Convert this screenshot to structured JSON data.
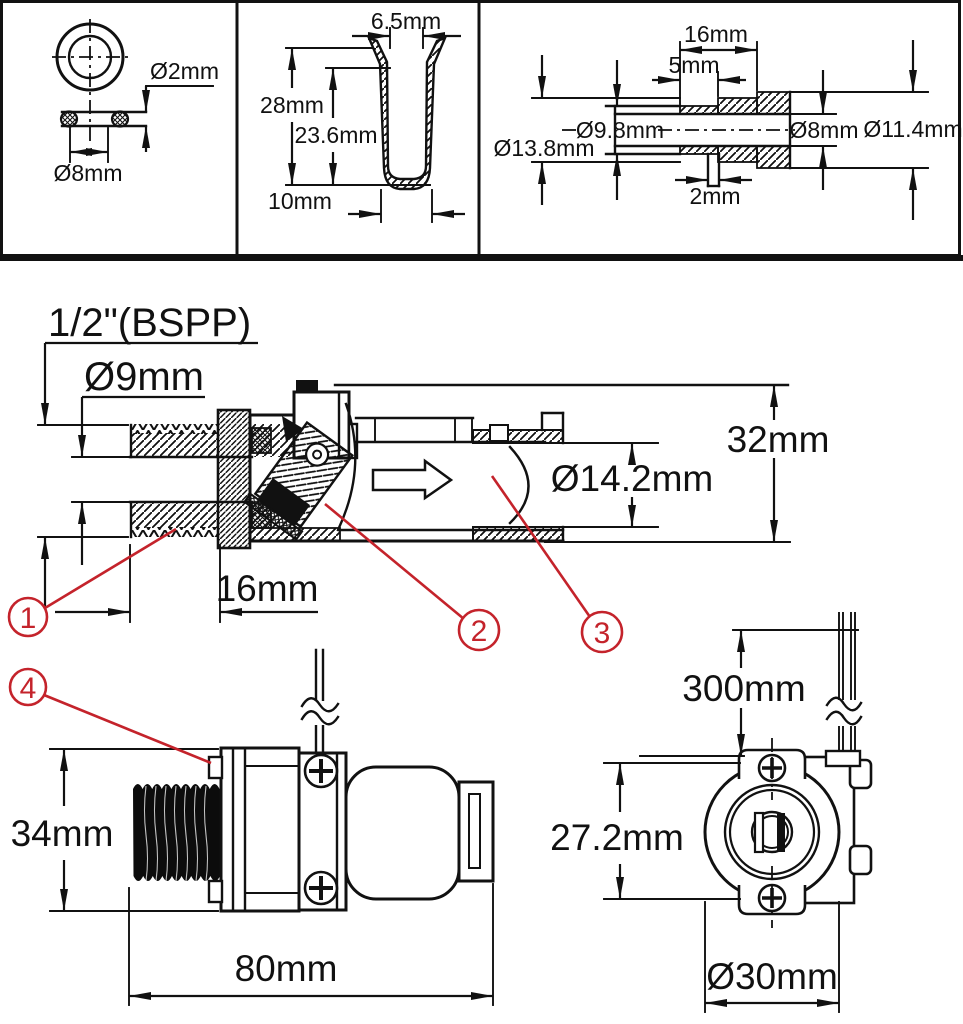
{
  "title": "Solenoid valve dimensional drawing",
  "colors": {
    "line": "#111111",
    "callout": "#c4232b",
    "background": "#ffffff"
  },
  "panels": {
    "oring": {
      "cross_section": "Ø2mm",
      "inner_diameter": "Ø8mm"
    },
    "filter": {
      "opening": "6.5mm",
      "height": "28mm",
      "inner_height": "23.6mm",
      "base": "10mm"
    },
    "fitting": {
      "length": "16mm",
      "step": "5mm",
      "tube_od": "Ø9.8mm",
      "flange_od": "Ø13.8mm",
      "bore": "Ø8mm",
      "collar_od": "Ø11.4mm",
      "pin": "2mm"
    }
  },
  "main_view": {
    "thread_spec": "1/2\"(BSPP)",
    "inlet_bore": "Ø9mm",
    "height": "32mm",
    "outlet_bore": "Ø14.2mm",
    "thread_length": "16mm",
    "callouts": {
      "c1": "1",
      "c2": "2",
      "c3": "3"
    }
  },
  "side_view": {
    "height": "34mm",
    "length": "80mm",
    "callout": "4"
  },
  "front_view": {
    "wire_length": "300mm",
    "screw_spacing": "27.2mm",
    "body_diameter": "Ø30mm"
  }
}
